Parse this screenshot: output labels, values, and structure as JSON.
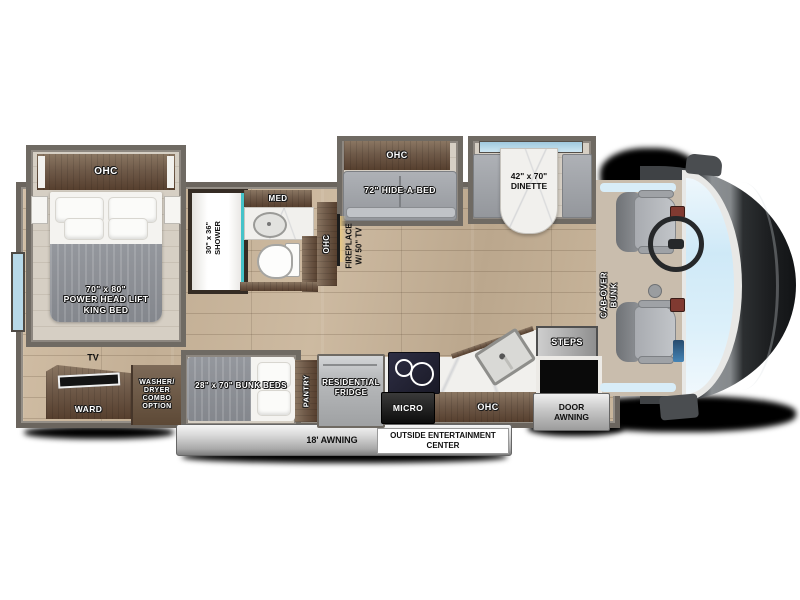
{
  "meta": {
    "type": "rv-floorplan",
    "view": "top-down"
  },
  "colors": {
    "floor_wood": "#c9b69c",
    "cabinet_wood": "#6b5646",
    "wall_gray": "#6f6a63",
    "upholstery_gray": "#9da0a5",
    "window_blue": "#cfe9f7",
    "marble_white": "#f1f0ed",
    "fireplace_glow": "#eecb7d",
    "awning_gray": "#b5b5b5"
  },
  "labels": {
    "bedroom_ohc": "OHC",
    "king_bed": "70\" x 80\"\nPOWER HEAD LIFT\nKING BED",
    "shower": "30\" x 36\"\nSHOWER",
    "med_cabinet": "MED",
    "hall_ohc": "OHC",
    "fireplace": "FIREPLACE\nW/ 50\" TV",
    "sofa_ohc": "OHC",
    "hide_a_bed": "72\" HIDE-A-BED",
    "dinette": "42\" x 70\"\nDINETTE",
    "cab_over_bunk": "CAB-OVER\nBUNK",
    "steps": "STEPS",
    "door_awning": "DOOR\nAWNING",
    "tv": "TV",
    "wardrobe": "WARD",
    "washer_dryer": "WASHER/\nDRYER\nCOMBO\nOPTION",
    "bunk_beds": "28\" x 70\" BUNK BEDS",
    "pantry": "PANTRY",
    "fridge": "RESIDENTIAL\nFRIDGE",
    "micro": "MICRO",
    "kitchen_ohc": "OHC",
    "awning": "18' AWNING",
    "outside_entertainment": "OUTSIDE ENTERTAINMENT\nCENTER"
  }
}
